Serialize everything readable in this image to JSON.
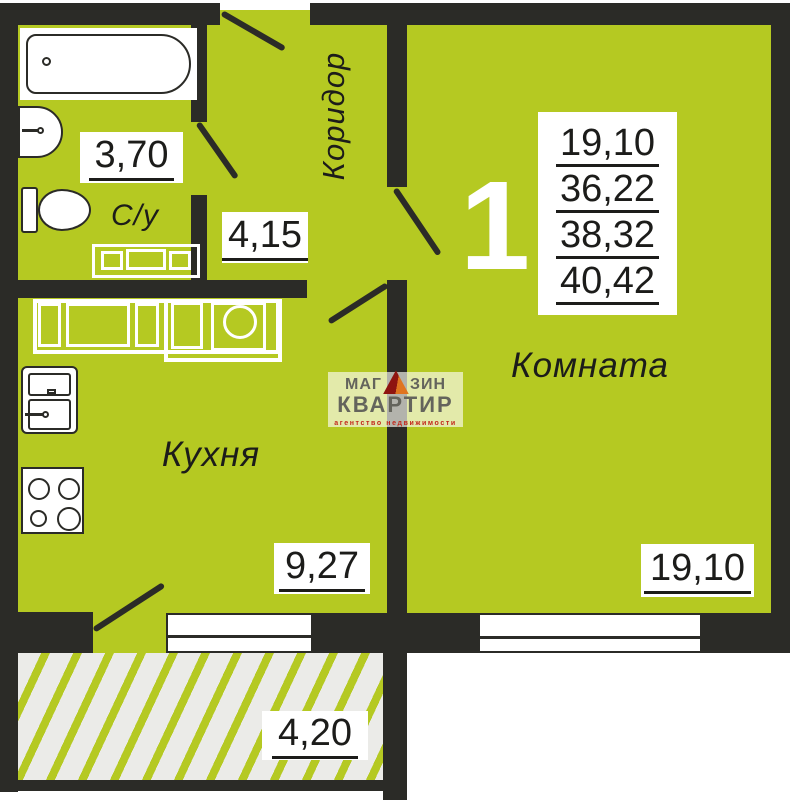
{
  "colors": {
    "floor_green": "#b5c922",
    "wall_black": "#2b2b27",
    "hatch_background": "#ebebe8",
    "label_text": "#1c1c1a",
    "watermark_gray": "#64645c",
    "watermark_red": "#c2261a"
  },
  "rooms": {
    "bathroom": {
      "name": "С/у",
      "area": "3,70"
    },
    "hall": {
      "area": "4,15"
    },
    "corridor": {
      "name": "Коридор"
    },
    "kitchen": {
      "name": "Кухня",
      "area": "9,27"
    },
    "living_room": {
      "name": "Комната",
      "area": "19,10"
    },
    "balcony": {
      "area": "4,20"
    }
  },
  "summary": {
    "rooms_count": "1",
    "values": [
      "19,10",
      "36,22",
      "38,32",
      "40,42"
    ]
  },
  "watermark": {
    "brand_top_left": "МАГ",
    "brand_top_right": "ЗИН",
    "brand_bottom": "КВАРТИР",
    "tagline": "агентство недвижимости"
  }
}
